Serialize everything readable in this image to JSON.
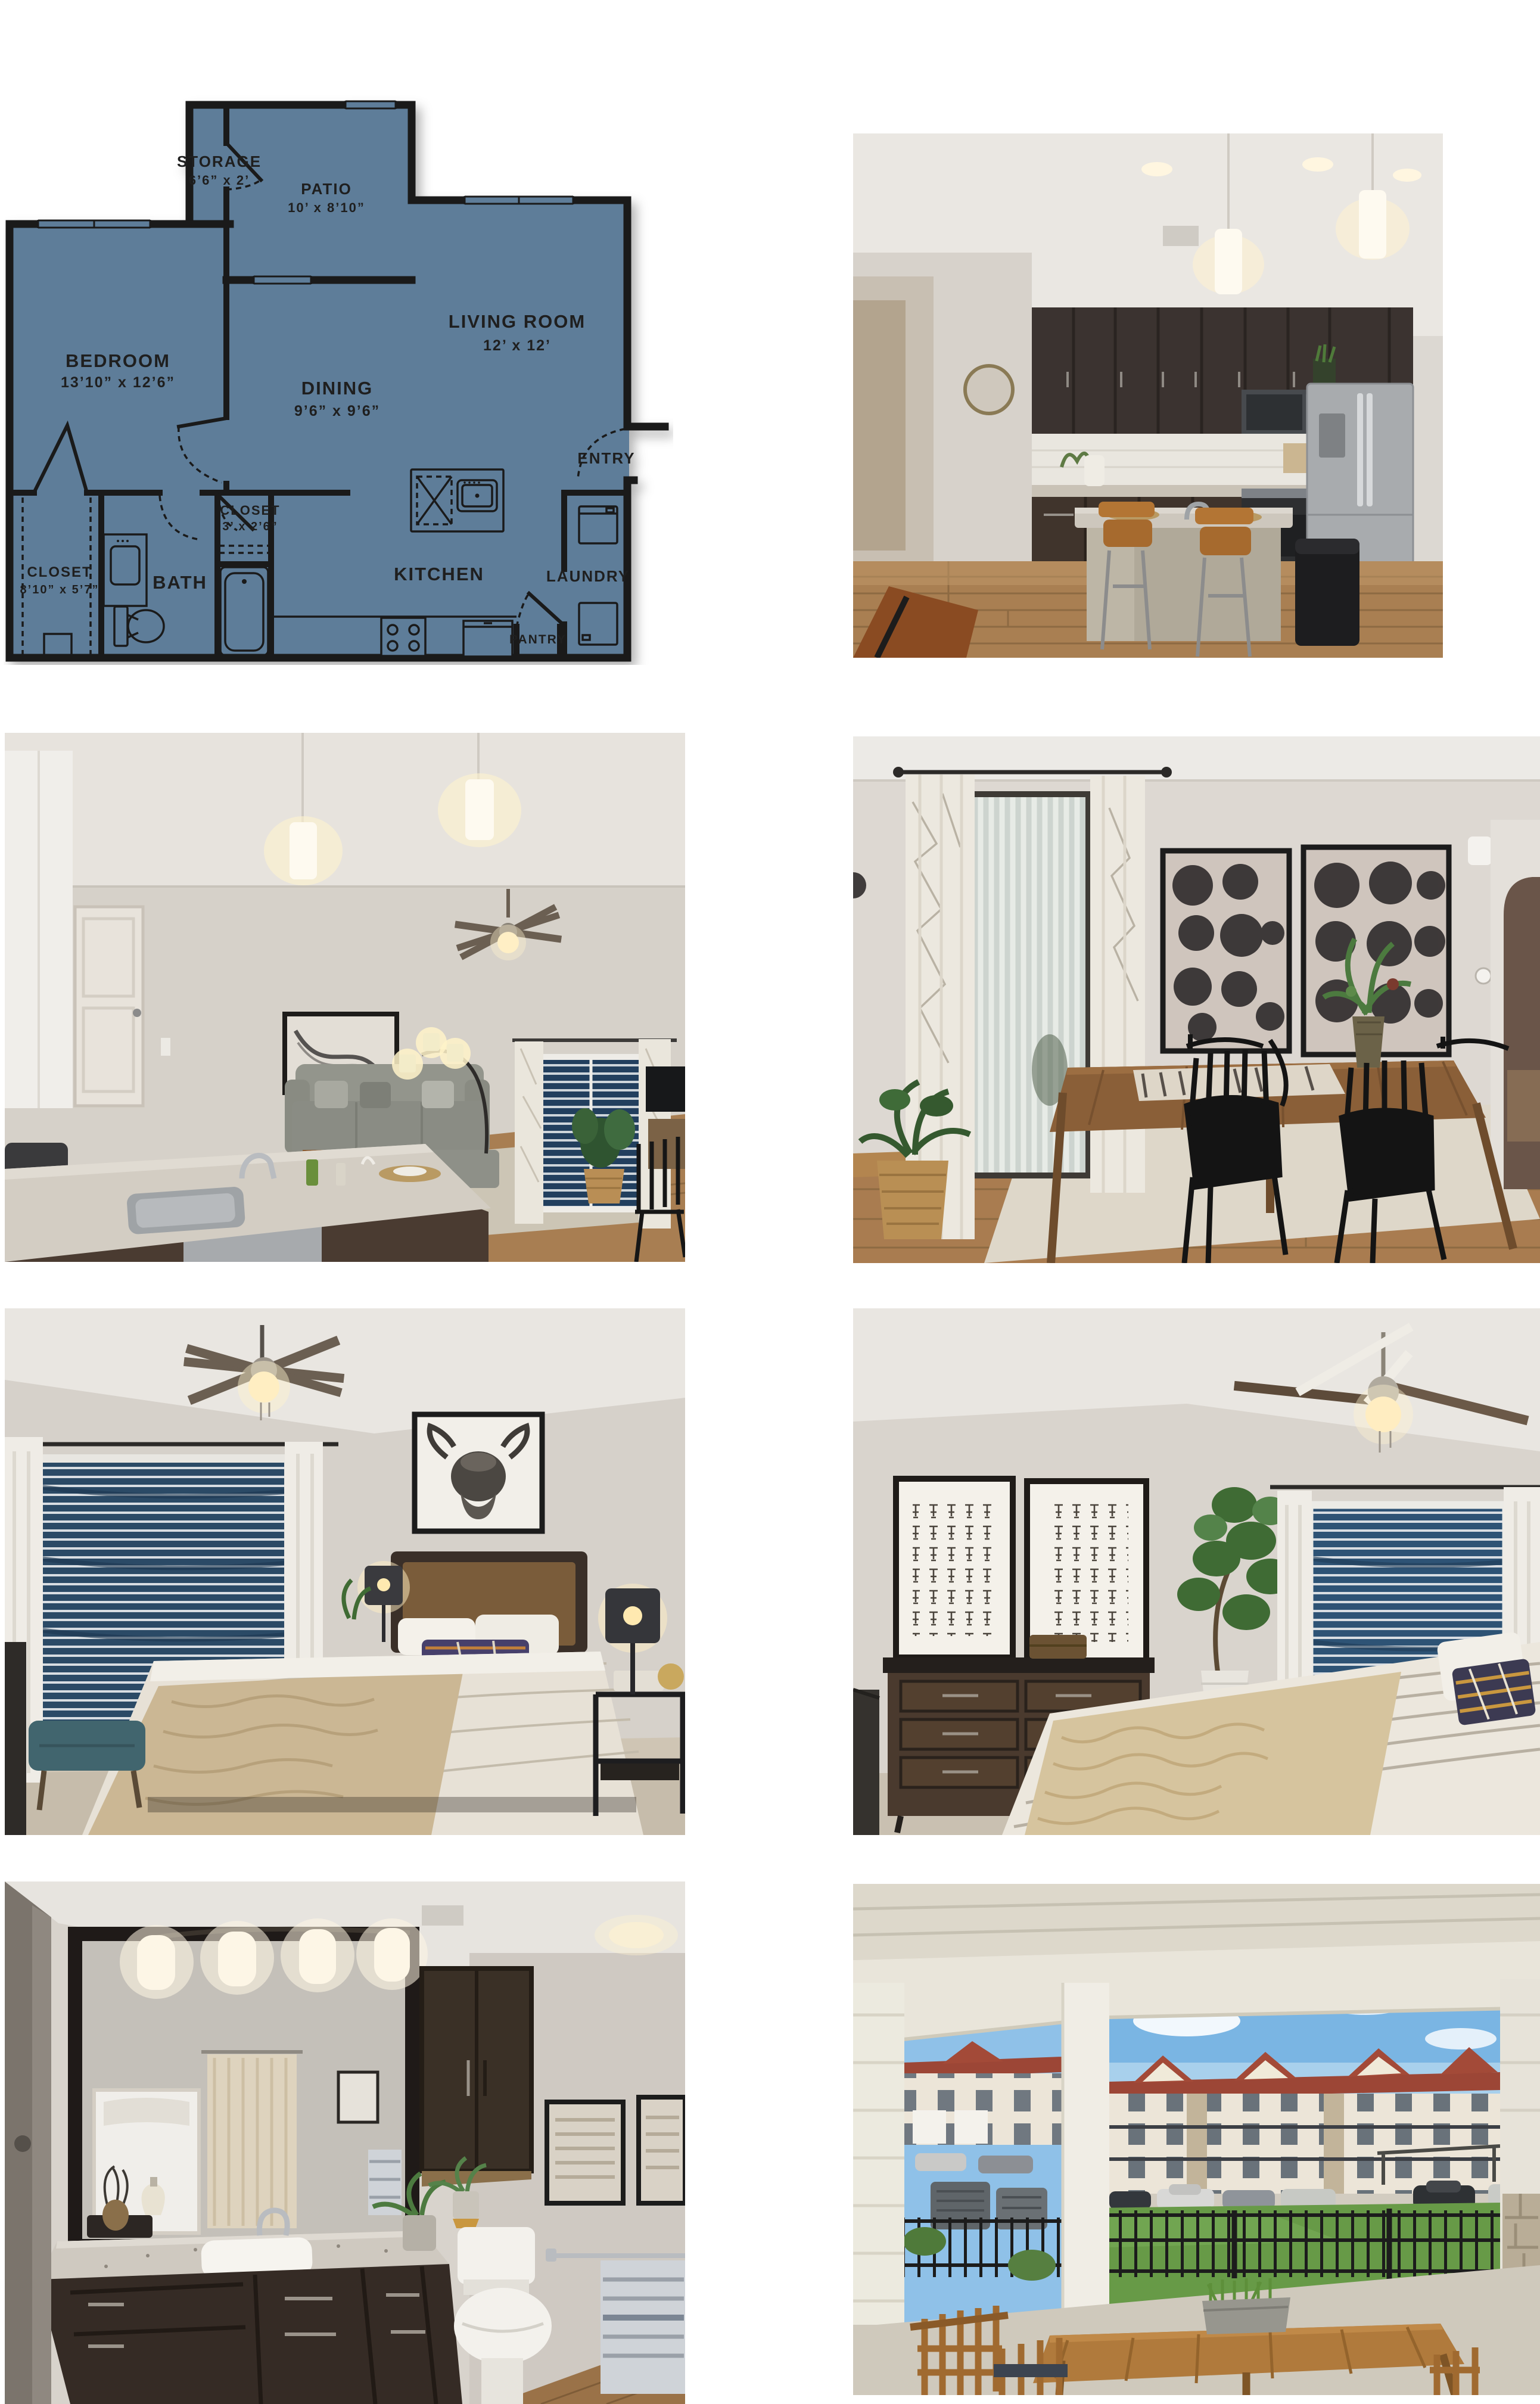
{
  "page": {
    "background": "#ffffff"
  },
  "floorplan": {
    "fill_color": "#5e7d99",
    "wall_color": "#1a1a1a",
    "rooms": {
      "bedroom": {
        "name": "BEDROOM",
        "dims": "13’10” x 12’6”"
      },
      "dining": {
        "name": "DINING",
        "dims": "9’6” x 9’6”"
      },
      "living": {
        "name": "LIVING ROOM",
        "dims": "12’ x 12’"
      },
      "patio": {
        "name": "PATIO",
        "dims": "10’ x 8’10”"
      },
      "storage": {
        "name": "STORAGE",
        "dims": "6’6” x 2’"
      },
      "closet_bed": {
        "name": "CLOSET",
        "dims": "8’10” x 5’7”"
      },
      "closet_hall": {
        "name": "CLOSET",
        "dims": "3’ x 2’6”"
      },
      "bath": {
        "name": "BATH"
      },
      "kitchen": {
        "name": "KITCHEN"
      },
      "laundry": {
        "name": "LAUNDRY"
      },
      "pantry": {
        "name": "PANTRY"
      },
      "entry": {
        "name": "ENTRY"
      }
    }
  },
  "photos": [
    {
      "id": "kitchen",
      "alt": "Kitchen with dark cabinets, granite island with wood barstools, and stainless steel refrigerator"
    },
    {
      "id": "living",
      "alt": "Open living room viewed over kitchen island with sink, gray sofa, arc floor lamp, ceiling fan and window with blue blinds"
    },
    {
      "id": "dining",
      "alt": "Dining nook with rustic wood table, four black spindle chairs, abstract circle artwork and patio door with vertical blinds"
    },
    {
      "id": "bedroom1",
      "alt": "Bedroom with highland cow art above bed, striped bedding, window with blue blinds and ceiling fan"
    },
    {
      "id": "bedroom2",
      "alt": "Bedroom with dark dresser, two framed prints, fiddle leaf fig plant and bed with fur throw"
    },
    {
      "id": "bathroom",
      "alt": "Bathroom with large framed mirror, four-globe vanity light, granite counter, dark cabinets and toilet"
    },
    {
      "id": "patio",
      "alt": "Covered back patio with wood dining set, fenced lawn, parking area and apartment buildings beyond"
    }
  ]
}
